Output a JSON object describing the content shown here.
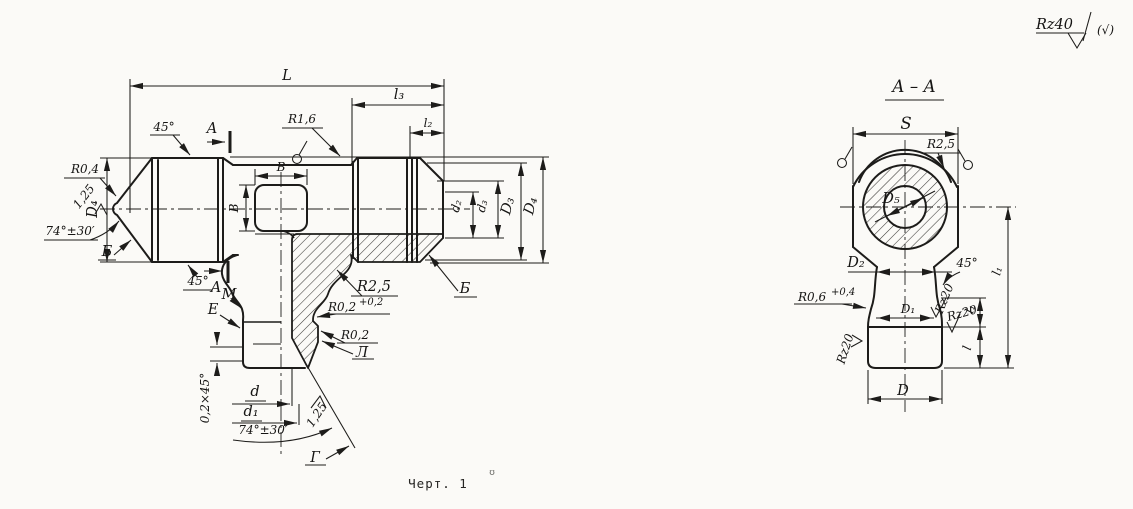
{
  "colors": {
    "ink": "#1d1c1a",
    "paper": "#fbfaf7"
  },
  "notes": {
    "general_roughness": "Rz40",
    "check_alt": "(√)",
    "caption": "Черт. 1",
    "stray": "ʊ"
  },
  "main_view": {
    "dims": {
      "L": "L",
      "l3": "l₃",
      "l2": "l₂",
      "B": "В",
      "D4": "D₄",
      "d2": "d₂",
      "d3": "d₃",
      "D3": "D₃",
      "d": "d",
      "d1": "d₁",
      "chamfer": "0,2×45°"
    },
    "angles": {
      "a45": "45°",
      "a74": "74°±30′"
    },
    "radii": {
      "r04": "R0,4",
      "r16": "R1,6",
      "r25": "R2,5",
      "r02": "R0,2",
      "r02_tol": "+0,2"
    },
    "roughness": {
      "r125": "1,25"
    },
    "section_mark": "A",
    "surfaces": {
      "b": "Б",
      "m": "M",
      "e": "E",
      "l": "Л",
      "g": "Г"
    }
  },
  "section_view": {
    "title": "А – А",
    "dims": {
      "S": "S",
      "D5": "D₅",
      "D2": "D₂",
      "D1": "D₁",
      "D": "D",
      "l1": "l₁",
      "l": "l"
    },
    "radii": {
      "r25": "R2,5",
      "r06": "R0,6",
      "r06_tol": "+0,4"
    },
    "angles": {
      "a45": "45°"
    },
    "roughness": {
      "rz20": "Rz20"
    }
  }
}
